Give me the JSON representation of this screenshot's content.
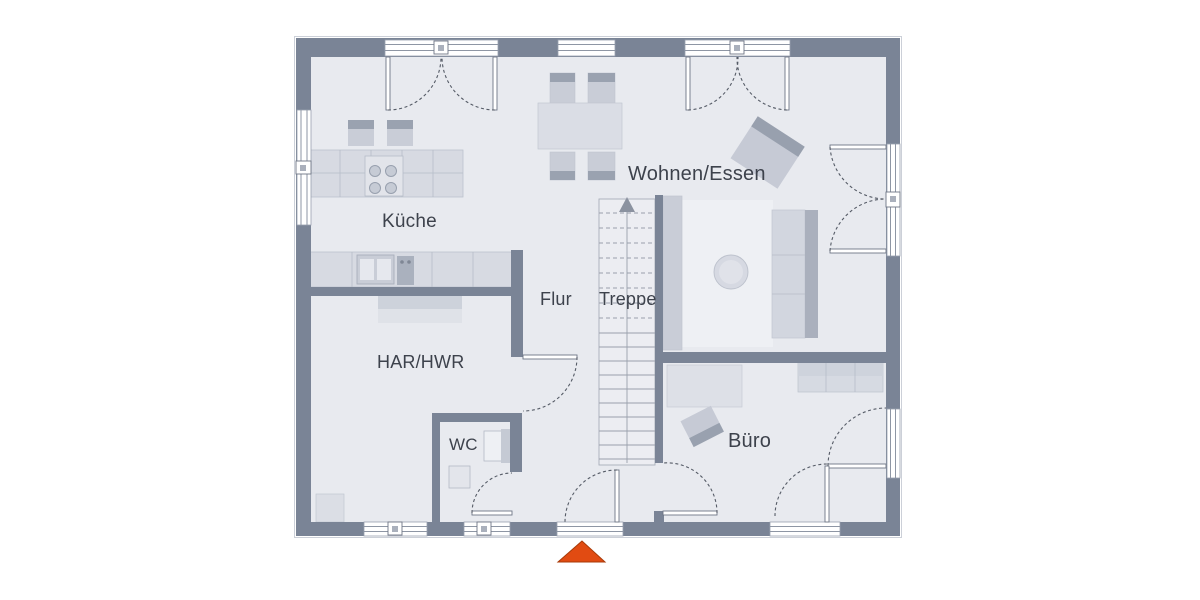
{
  "plan": {
    "rooms": [
      {
        "id": "kueche",
        "name": "Küche"
      },
      {
        "id": "wohnen-essen",
        "name": "Wohnen/Essen"
      },
      {
        "id": "flur",
        "name": "Flur"
      },
      {
        "id": "treppe",
        "name": "Treppe"
      },
      {
        "id": "har-hwr",
        "name": "HAR/HWR"
      },
      {
        "id": "wc",
        "name": "WC"
      },
      {
        "id": "buero",
        "name": "Büro"
      }
    ],
    "markers": {
      "entrance_icon": "entrance-arrow",
      "stairs_direction": "up"
    },
    "colors": {
      "wall": "#7a8496",
      "floor": "#e8eaef",
      "rug": "#eef0f4",
      "furniture_light": "#d7dae2",
      "furniture_mid": "#c9cdd7",
      "furniture_dark": "#9aa2b0",
      "glazing": "#8e96a4",
      "arc": "#555b66",
      "stair_line": "#9aa0ac",
      "text": "#3d424c",
      "entrance_accent": "#e14b12"
    }
  }
}
